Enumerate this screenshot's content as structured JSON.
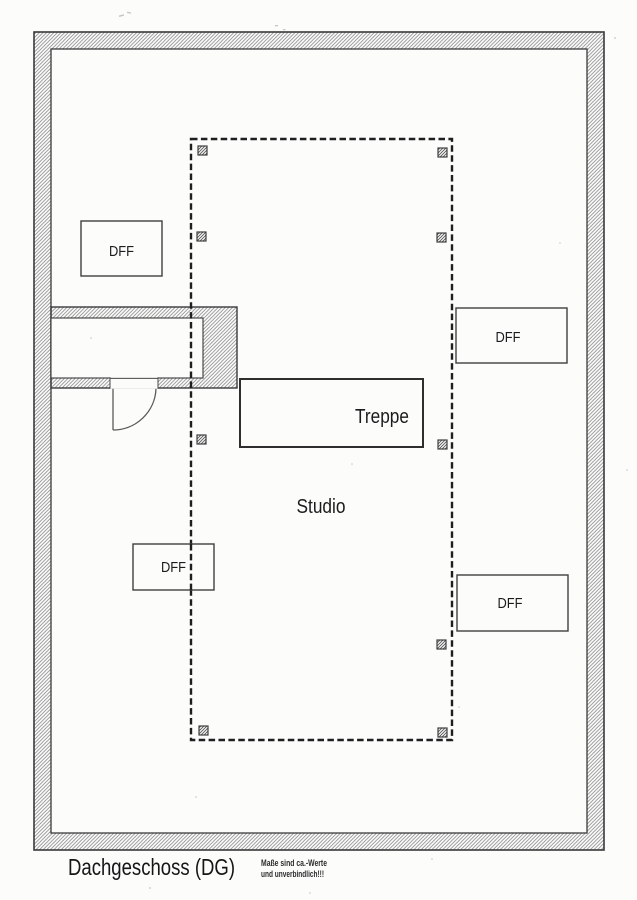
{
  "plan": {
    "title": "Dachgeschoss (DG)",
    "disclaimer": [
      "Maße sind ca.-Werte",
      "und unverbindlich!!!"
    ],
    "rooms": {
      "studio": "Studio",
      "stairs": "Treppe"
    },
    "roof_windows": [
      {
        "id": "dff-top-left",
        "label": "DFF"
      },
      {
        "id": "dff-right-upper",
        "label": "DFF"
      },
      {
        "id": "dff-left-middle",
        "label": "DFF"
      },
      {
        "id": "dff-right-lower",
        "label": "DFF"
      }
    ],
    "markers": {
      "post_count": 9
    },
    "colors": {
      "ink": "#2f2f2f",
      "hatch_line": "#8c8c8c",
      "paper": "#fcfcfb"
    }
  }
}
